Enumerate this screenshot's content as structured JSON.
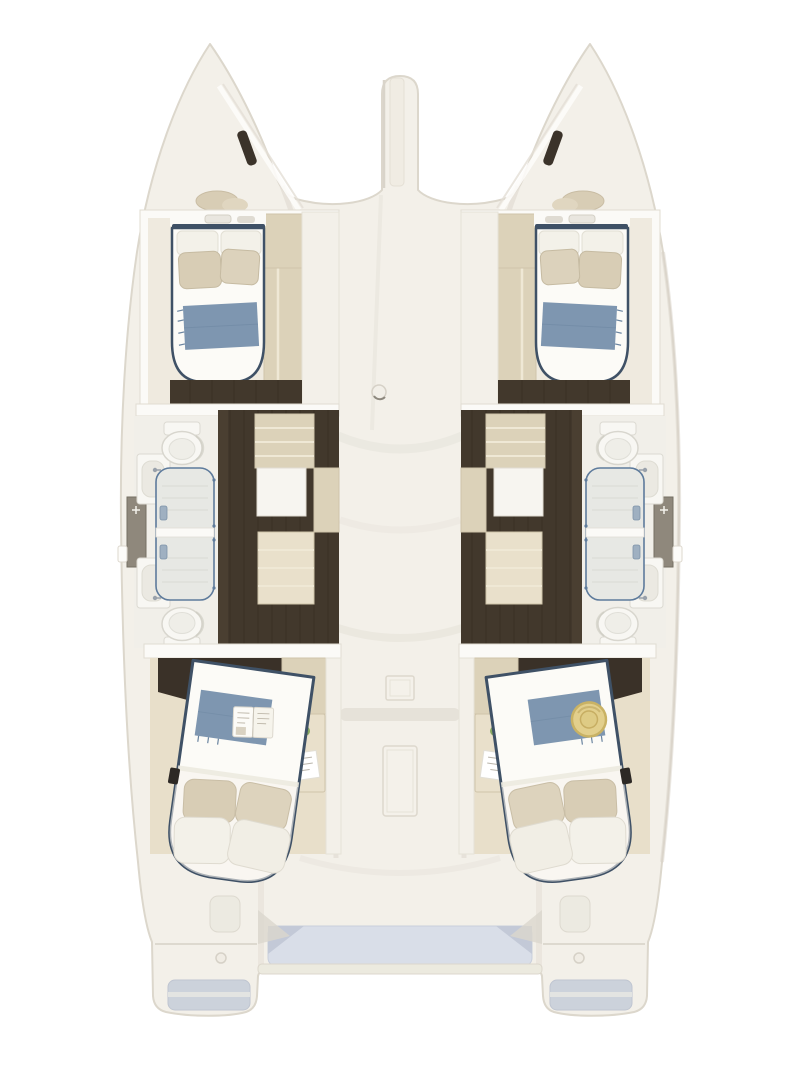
{
  "meta": {
    "title": "Catamaran four-cabin interior layout, top-down floor plan",
    "view": "top-down"
  },
  "colors": {
    "white": "#fdfcf9",
    "deck": "#f3f0e9",
    "deck_shadow": "#e6e2d9",
    "wall": "#fbfaf7",
    "floor_cream": "#efeadf",
    "floor_beige": "#e8dfca",
    "wood_dark": "#42382c",
    "wood_head": "#3a3128",
    "tan": "#dcd2b9",
    "tan_light": "#e9e0cb",
    "fixture": "#f8f7f3",
    "fixture_shadow": "#dcdad2",
    "bed": "#fcfbf7",
    "pillow_white": "#f3f1e9",
    "pillow_beige": "#d8cdb5",
    "navy": "#3f5166",
    "blue_throw": "#7e96b0",
    "glass": "#5e7b9c",
    "shower_tray": "#e7e8e4",
    "tray_line": "#d8dad5",
    "cabinet_gray": "#8f887c",
    "cockpit_blue": "#d9dee8",
    "cockpit_blue_dark": "#c3c9d7",
    "cockpit_lip": "#eceadf",
    "plant_green": "#6d8f4f",
    "plant_green_light": "#87a861",
    "hat": "#e2cf8c",
    "hat_dark": "#c9b264",
    "slot_dark": "#3b332a",
    "outline": "#dcd7cc",
    "shadow_soft": "#e3dfd6"
  },
  "vessel": {
    "hull_count": 2,
    "bridgedeck": {
      "features": [
        "bowsprit",
        "anchor-deck-filler",
        "square-deck-hatch",
        "long-deck-hatch",
        "step-shadow",
        "cockpit-recessed-floor"
      ]
    },
    "port_hull": {
      "bow_locker": [
        "stowed-cushions",
        "deck-slot-hatch"
      ],
      "forward_cabin": [
        "double-bed",
        "white-pillows",
        "beige-pillows",
        "blue-throw",
        "wardrobe",
        "headboard-shelf"
      ],
      "forward_bathroom": [
        "toilet",
        "vanity-sink",
        "shower-stall"
      ],
      "aft_bathroom": [
        "toilet",
        "vanity-sink",
        "shower-stall"
      ],
      "corridor": [
        "dark-wood-floor",
        "companionway-steps",
        "storage-cabinet",
        "white-appliance"
      ],
      "aft_cabin": [
        "double-bed-angled",
        "pillows",
        "blue-throw",
        "open-book",
        "nightstand",
        "note-paper",
        "plant",
        "remote"
      ],
      "stern": [
        "step-locker",
        "cleat",
        "transom-swim-step"
      ]
    },
    "starboard_hull": {
      "bow_locker": [
        "stowed-cushions",
        "deck-slot-hatch"
      ],
      "forward_cabin": [
        "double-bed",
        "white-pillows",
        "beige-pillows",
        "blue-throw",
        "wardrobe",
        "headboard-shelf"
      ],
      "forward_bathroom": [
        "toilet",
        "vanity-sink",
        "shower-stall"
      ],
      "aft_bathroom": [
        "toilet",
        "vanity-sink",
        "shower-stall"
      ],
      "corridor": [
        "dark-wood-floor",
        "companionway-steps",
        "storage-cabinet",
        "white-appliance"
      ],
      "aft_cabin": [
        "double-bed-angled",
        "pillows",
        "blue-throw",
        "straw-sun-hat",
        "nightstand",
        "plant"
      ],
      "stern": [
        "step-locker",
        "cleat",
        "transom-swim-step"
      ]
    }
  }
}
